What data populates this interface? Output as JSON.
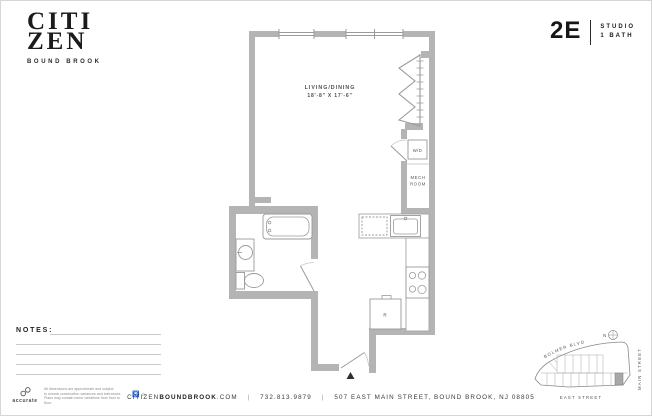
{
  "brand": {
    "line1": "CITI",
    "line2": "ZEN",
    "tagline": "BOUND BROOK"
  },
  "unit": {
    "number": "2E",
    "type": "STUDIO",
    "bath": "1 BATH"
  },
  "plan": {
    "room": {
      "name": "LIVING/DINING",
      "dims": "18'-8\" X 17'-6\""
    },
    "labels": {
      "wd": "W/D",
      "mech1": "MECH",
      "mech2": "ROOM",
      "dw": "DW",
      "fridge": "R"
    }
  },
  "notes": {
    "label": "NOTES:"
  },
  "sitemap": {
    "street_top": "BOLMER BLVD",
    "street_right": "MAIN STREET",
    "street_bottom": "EAST STREET",
    "compass": "N"
  },
  "footer": {
    "web_pre": "CITIZEN",
    "web_bold": "BOUNDBROOK",
    "web_suf": ".COM",
    "sep1": "|",
    "sep2": "|",
    "phone": "732.813.9879",
    "address": "507 EAST MAIN STREET, BOUND BROOK, NJ 08805"
  },
  "legal": {
    "brand": "accurate",
    "lines": [
      "All dimensions are approximate and subject",
      "to normal construction variances and tolerances.",
      "Plans may contain minor variations from floor to floor."
    ],
    "ada": "♿",
    "eho": "⌂"
  },
  "colors": {
    "wall": "#b4b4b4",
    "fixture_line": "#9a9a9a",
    "text": "#3c3c3c",
    "unit_highlight": "#a8a8a8"
  }
}
